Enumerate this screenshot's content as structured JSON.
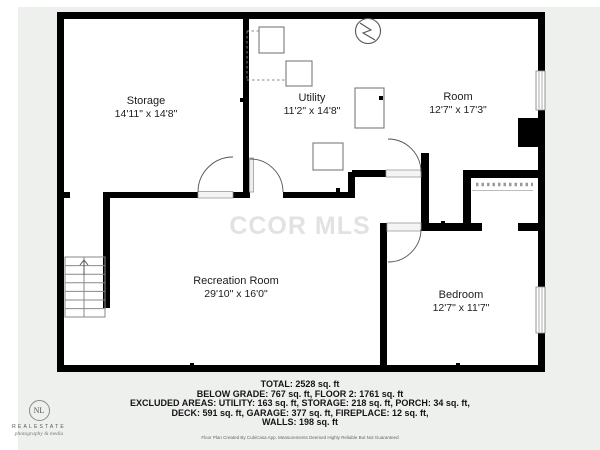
{
  "watermark": "CCOR MLS",
  "colors": {
    "wall": "#000000",
    "background": "#eef0ee",
    "watermark_text": "#e1e3e1"
  },
  "rooms": [
    {
      "name": "Storage",
      "dimensions": "14'11\" x 14'8\""
    },
    {
      "name": "Utility",
      "dimensions": "11'2\" x 14'8\""
    },
    {
      "name": "Room",
      "dimensions": "12'7\" x 17'3\""
    },
    {
      "name": "Recreation Room",
      "dimensions": "29'10\" x 16'0\""
    },
    {
      "name": "Bedroom",
      "dimensions": "12'7\" x 11'7\""
    }
  ],
  "footer": {
    "total": "TOTAL: 2528 sq. ft",
    "line2": "BELOW GRADE: 767 sq. ft, FLOOR 2: 1761 sq. ft",
    "line3": "EXCLUDED AREAS: UTILITY: 163 sq. ft, STORAGE: 218 sq. ft, PORCH: 34 sq. ft,",
    "line4": "DECK: 591 sq. ft, GARAGE: 377 sq. ft, FIREPLACE: 12 sq. ft,",
    "line5": "WALLS: 198 sq. ft",
    "disclaimer": "Floor Plan Created By CubiCasa App. Measurements Deemed Highly Reliable But Not Guaranteed"
  },
  "logo": {
    "monogram": "NL",
    "name": "REALESTATE",
    "tagline": "photography & media"
  }
}
